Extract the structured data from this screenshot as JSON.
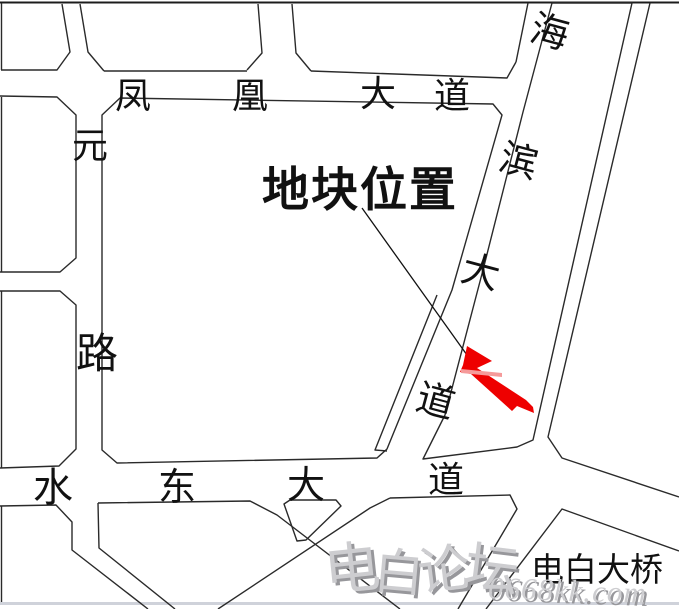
{
  "map": {
    "highlight": {
      "label": "地块位置",
      "label_color": "#ee0000",
      "marker_color": "#ee0000"
    },
    "roads": {
      "fenghuang": {
        "full_name": "凤凰大道",
        "chars": [
          "凤",
          "凰",
          "大",
          "道"
        ]
      },
      "yuanlu": {
        "full_name": "元路",
        "chars": [
          "元",
          "路"
        ]
      },
      "haibin": {
        "full_name": "海滨大道",
        "chars": [
          "海",
          "滨",
          "大",
          "道"
        ]
      },
      "shuidong": {
        "full_name": "水东大道",
        "chars": [
          "水",
          "东",
          "大",
          "道"
        ]
      },
      "bridge_label": "电白大桥"
    },
    "watermark": {
      "brand": "电白论坛",
      "brand_chars": [
        "电",
        "白",
        "论",
        "坛"
      ],
      "site": "0668kk.com"
    },
    "colors": {
      "road_line": "#2a2a2a",
      "highlight_red": "#ee0000",
      "watermark_fill": "#cdcdd0",
      "watermark_shadow": "#97979b",
      "bottom_bar": "#cfd2da"
    }
  }
}
